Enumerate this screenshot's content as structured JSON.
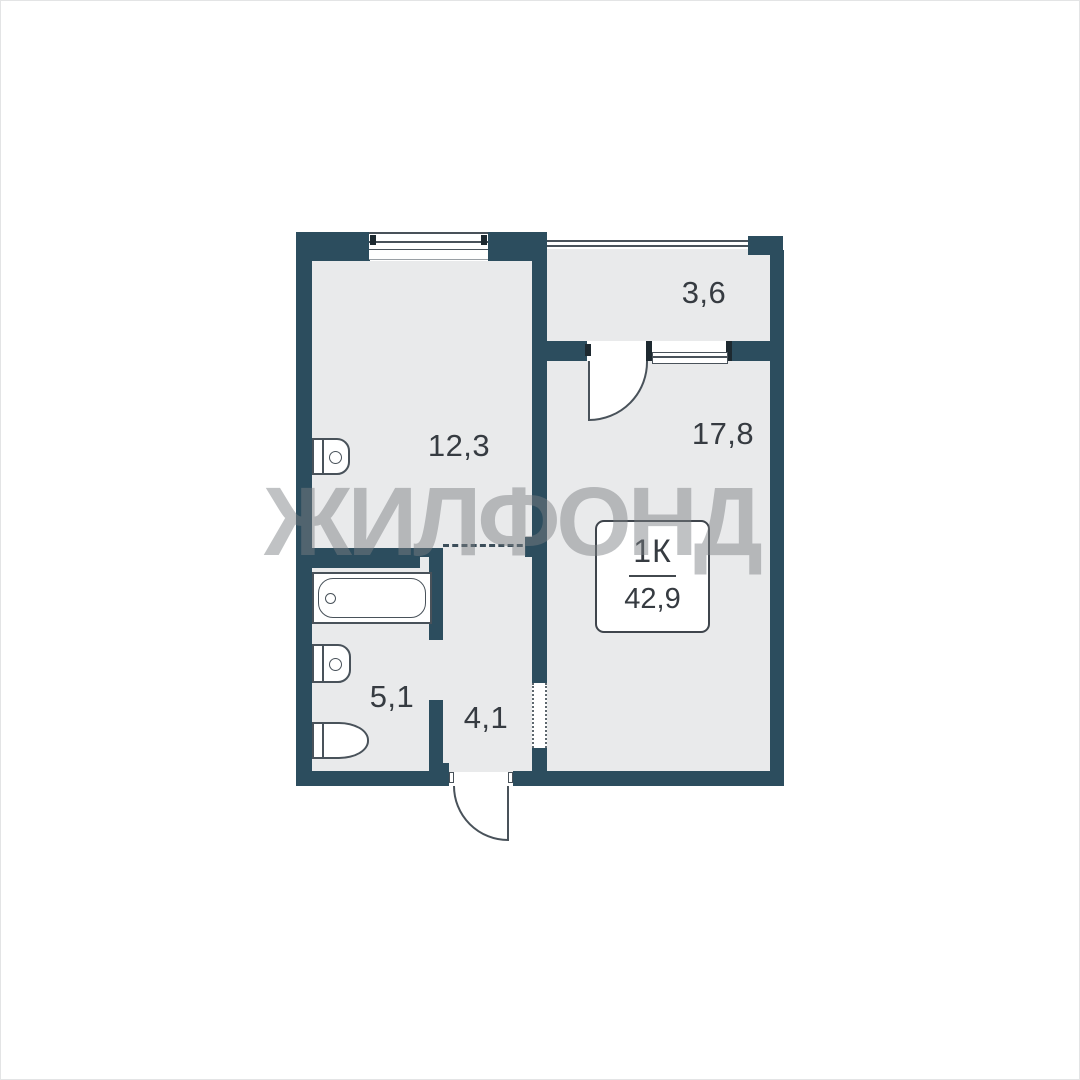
{
  "watermark": {
    "text": "ЖИЛФОНД"
  },
  "info_box": {
    "type": "1К",
    "total_area": "42,9"
  },
  "rooms": {
    "kitchen": {
      "area": "12,3"
    },
    "living": {
      "area": "17,8"
    },
    "balcony": {
      "area": "3,6"
    },
    "bathroom": {
      "area": "5,1"
    },
    "hallway": {
      "area": "4,1"
    }
  },
  "colors": {
    "wall": "#2c4d5e",
    "room": "#e9eaeb",
    "line": "#49525a",
    "dark": "#1d2930",
    "text": "#363b41",
    "watermark": "#7b7f83",
    "frame": "#e3e4e5"
  }
}
